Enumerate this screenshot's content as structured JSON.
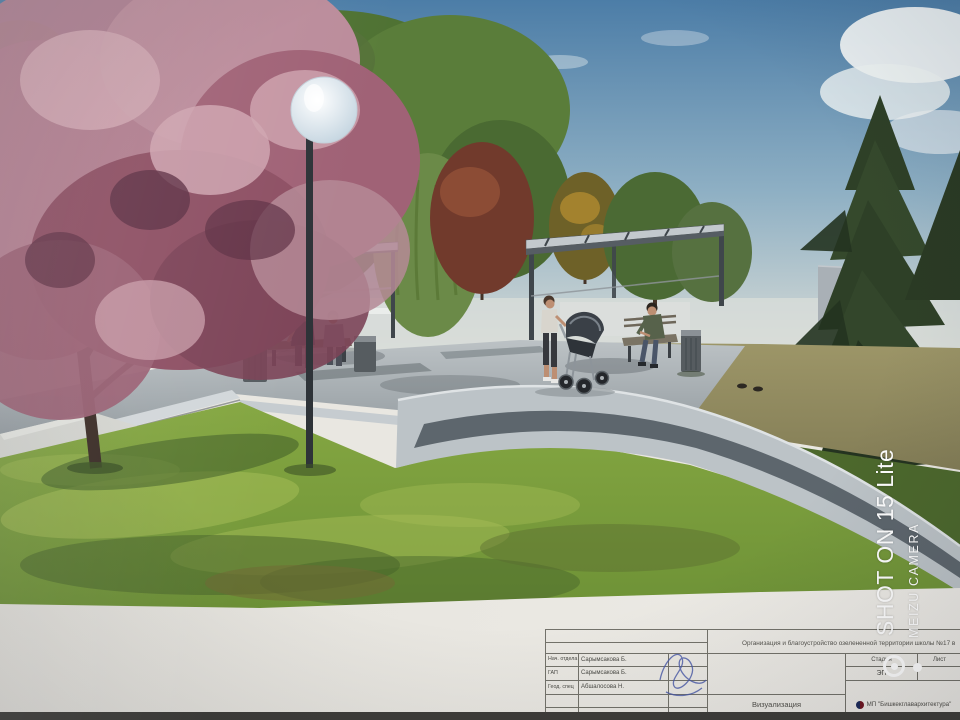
{
  "watermark": {
    "line1": "SHOT ON 15 Lite",
    "line2": "MEIZU CAMERA"
  },
  "titleblock": {
    "project_title": "Организация и благоустройство озелененной территории школы №17 в",
    "rows": [
      {
        "role": "Нач. отдела",
        "name": "Сарымсакова Б."
      },
      {
        "role": "ГАП",
        "name": "Сарымсакова Б."
      },
      {
        "role": "Геод. спец",
        "name": "Абшалосова Н."
      }
    ],
    "stage_label": "Стадия",
    "sheet_label": "Лист",
    "stage_value": "ЭП",
    "doc_type": "Визуализация",
    "organization": "МП \"Бишкекглавархитектура\""
  },
  "colors": {
    "paper": "#e9e7e1",
    "table_line": "#73726a",
    "ink": "#3f3f3c",
    "watermark": "#ffffff",
    "signature": "#4757a8",
    "photo_edge": "#3e3d39",
    "sky_top": "#4c7da7",
    "sky_horizon": "#d7dbd6",
    "foliage": "#4f7233",
    "foliage_dark": "#3c5629",
    "willow": "#6b8a48",
    "red_tree": "#713a2c",
    "orange_tree": "#a8862f",
    "conifer": "#2e4027",
    "conifer_dark": "#243320",
    "blossom": "#b27f90",
    "blossom_light": "#cfa5b0",
    "blossom_dark": "#7c4458",
    "trunk": "#3b2c26",
    "grass": "#7fa03c",
    "grass_light": "#a8bf58",
    "grass_dark": "#4c682c",
    "tan_ground": "#8e875f",
    "pavement": "#9aa1a6",
    "pavement_dark": "#626b70",
    "plaza_edge": "#d2d7da",
    "walkway": "#bcc3c7",
    "walkway_band": "#5d666d",
    "building": "#a9b0b6",
    "metal": "#3f464b",
    "metal_light": "#c3c9cd",
    "lamp_pole": "#2e3338",
    "bin": "#565c60",
    "skin": "#bd8f73"
  }
}
